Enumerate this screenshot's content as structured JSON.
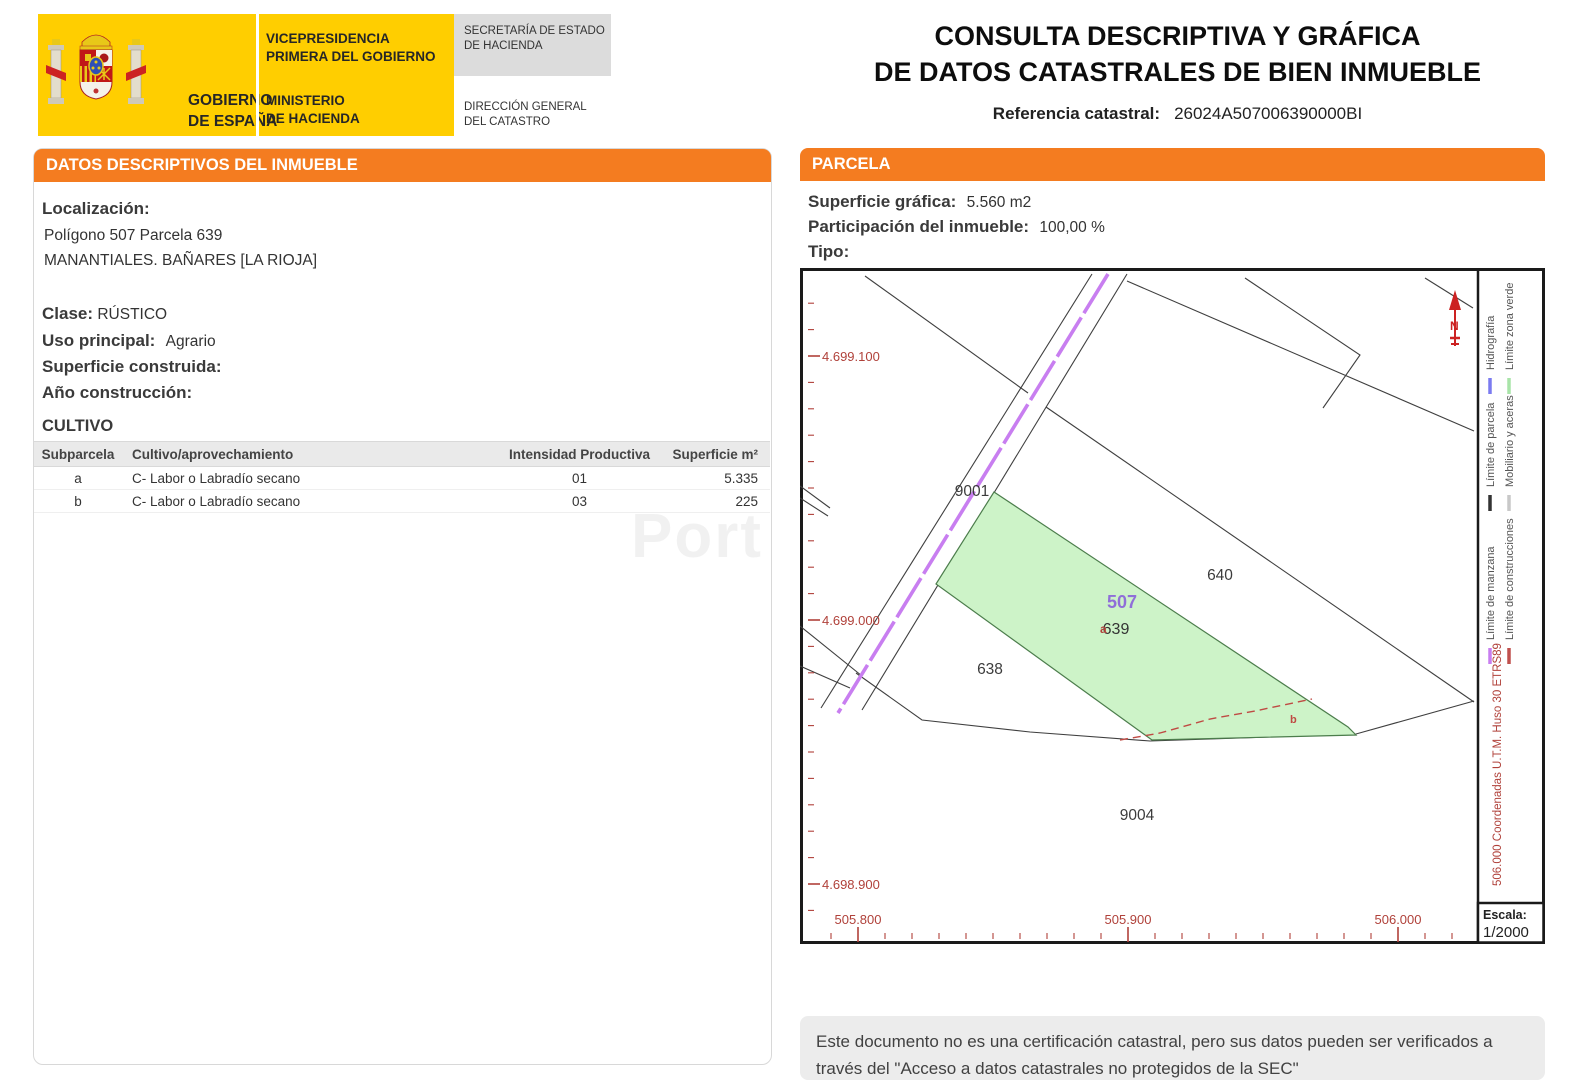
{
  "header": {
    "logo_text_1": "GOBIERNO",
    "logo_text_2": "DE ESPAÑA",
    "dept_1a": "VICEPRESIDENCIA",
    "dept_1b": "PRIMERA DEL GOBIERNO",
    "dept_2a": "MINISTERIO",
    "dept_2b": "DE HACIENDA",
    "secretaria_1": "SECRETARÍA DE ESTADO",
    "secretaria_2": "DE HACIENDA",
    "direccion_1": "DIRECCIÓN GENERAL",
    "direccion_2": "DEL CATASTRO",
    "title_line1": "CONSULTA DESCRIPTIVA Y GRÁFICA",
    "title_line2": "DE DATOS CATASTRALES DE BIEN INMUEBLE",
    "ref_label": "Referencia catastral:",
    "ref_value": "26024A507006390000BI"
  },
  "left_panel": {
    "section_title": "DATOS DESCRIPTIVOS DEL INMUEBLE",
    "localizacion_label": "Localización:",
    "localizacion_line1": "Polígono 507 Parcela 639",
    "localizacion_line2": "MANANTIALES. BAÑARES [LA RIOJA]",
    "clase_label": "Clase:",
    "clase_value": "RÚSTICO",
    "uso_label": "Uso principal:",
    "uso_value": "Agrario",
    "superficie_label": "Superficie construida:",
    "superficie_value": "",
    "anio_label": "Año construcción:",
    "anio_value": "",
    "cultivo_title": "CULTIVO",
    "cultivo_table": {
      "headers": [
        "Subparcela",
        "Cultivo/aprovechamiento",
        "Intensidad Productiva",
        "Superficie m²"
      ],
      "rows": [
        {
          "subparcela": "a",
          "cultivo": "C- Labor o Labradío secano",
          "intensidad": "01",
          "superficie": "5.335"
        },
        {
          "subparcela": "b",
          "cultivo": "C- Labor o Labradío secano",
          "intensidad": "03",
          "superficie": "225"
        }
      ]
    },
    "watermark": "Port"
  },
  "right_panel": {
    "section_title": "PARCELA",
    "superficie_label": "Superficie gráfica:",
    "superficie_value": "5.560 m2",
    "participacion_label": "Participación del inmueble:",
    "participacion_value": "100,00 %",
    "tipo_label": "Tipo:",
    "tipo_value": ""
  },
  "map": {
    "labels": {
      "p9001": "9001",
      "p638": "638",
      "p640": "640",
      "p9004": "9004",
      "p507": "507",
      "p639": "639",
      "sub_a": "a",
      "sub_b": "b"
    },
    "y_axis_labels": [
      "4.699.100",
      "4.699.000",
      "4.698.900"
    ],
    "x_axis_labels": [
      "505.800",
      "505.900",
      "506.000"
    ],
    "utm_text": "506.000 Coordenadas U.T.M. Huso 30 ETRS89",
    "escala_label": "Escala:",
    "escala_value": "1/2000",
    "north_label": "N",
    "legend": [
      {
        "label": "Hidrografía",
        "color": "#7b7bf0"
      },
      {
        "label": "Límite zona verde",
        "color": "#a8e4a8"
      },
      {
        "label": "Límite de parcela",
        "color": "#333333"
      },
      {
        "label": "Mobiliario y aceras",
        "color": "#c8c8c8"
      },
      {
        "label": "Límite de manzana",
        "color": "#c87ef0"
      },
      {
        "label": "Límite de construcciones",
        "color": "#c0504d"
      }
    ],
    "colors": {
      "coordinate_red": "#b0413a",
      "road_purple": "#c87ef0",
      "green_fill": "#cdf3c8",
      "green_stroke": "#4c7d4c",
      "parcel_line": "#3f3f3f",
      "sector_purple": "#8f6fd8",
      "north_red": "#cc2222"
    }
  },
  "footer": {
    "line1": "Este documento no es una certificación catastral, pero sus datos pueden ser verificados a",
    "line2": "través del \"Acceso a datos catastrales no protegidos de la SEC\""
  }
}
